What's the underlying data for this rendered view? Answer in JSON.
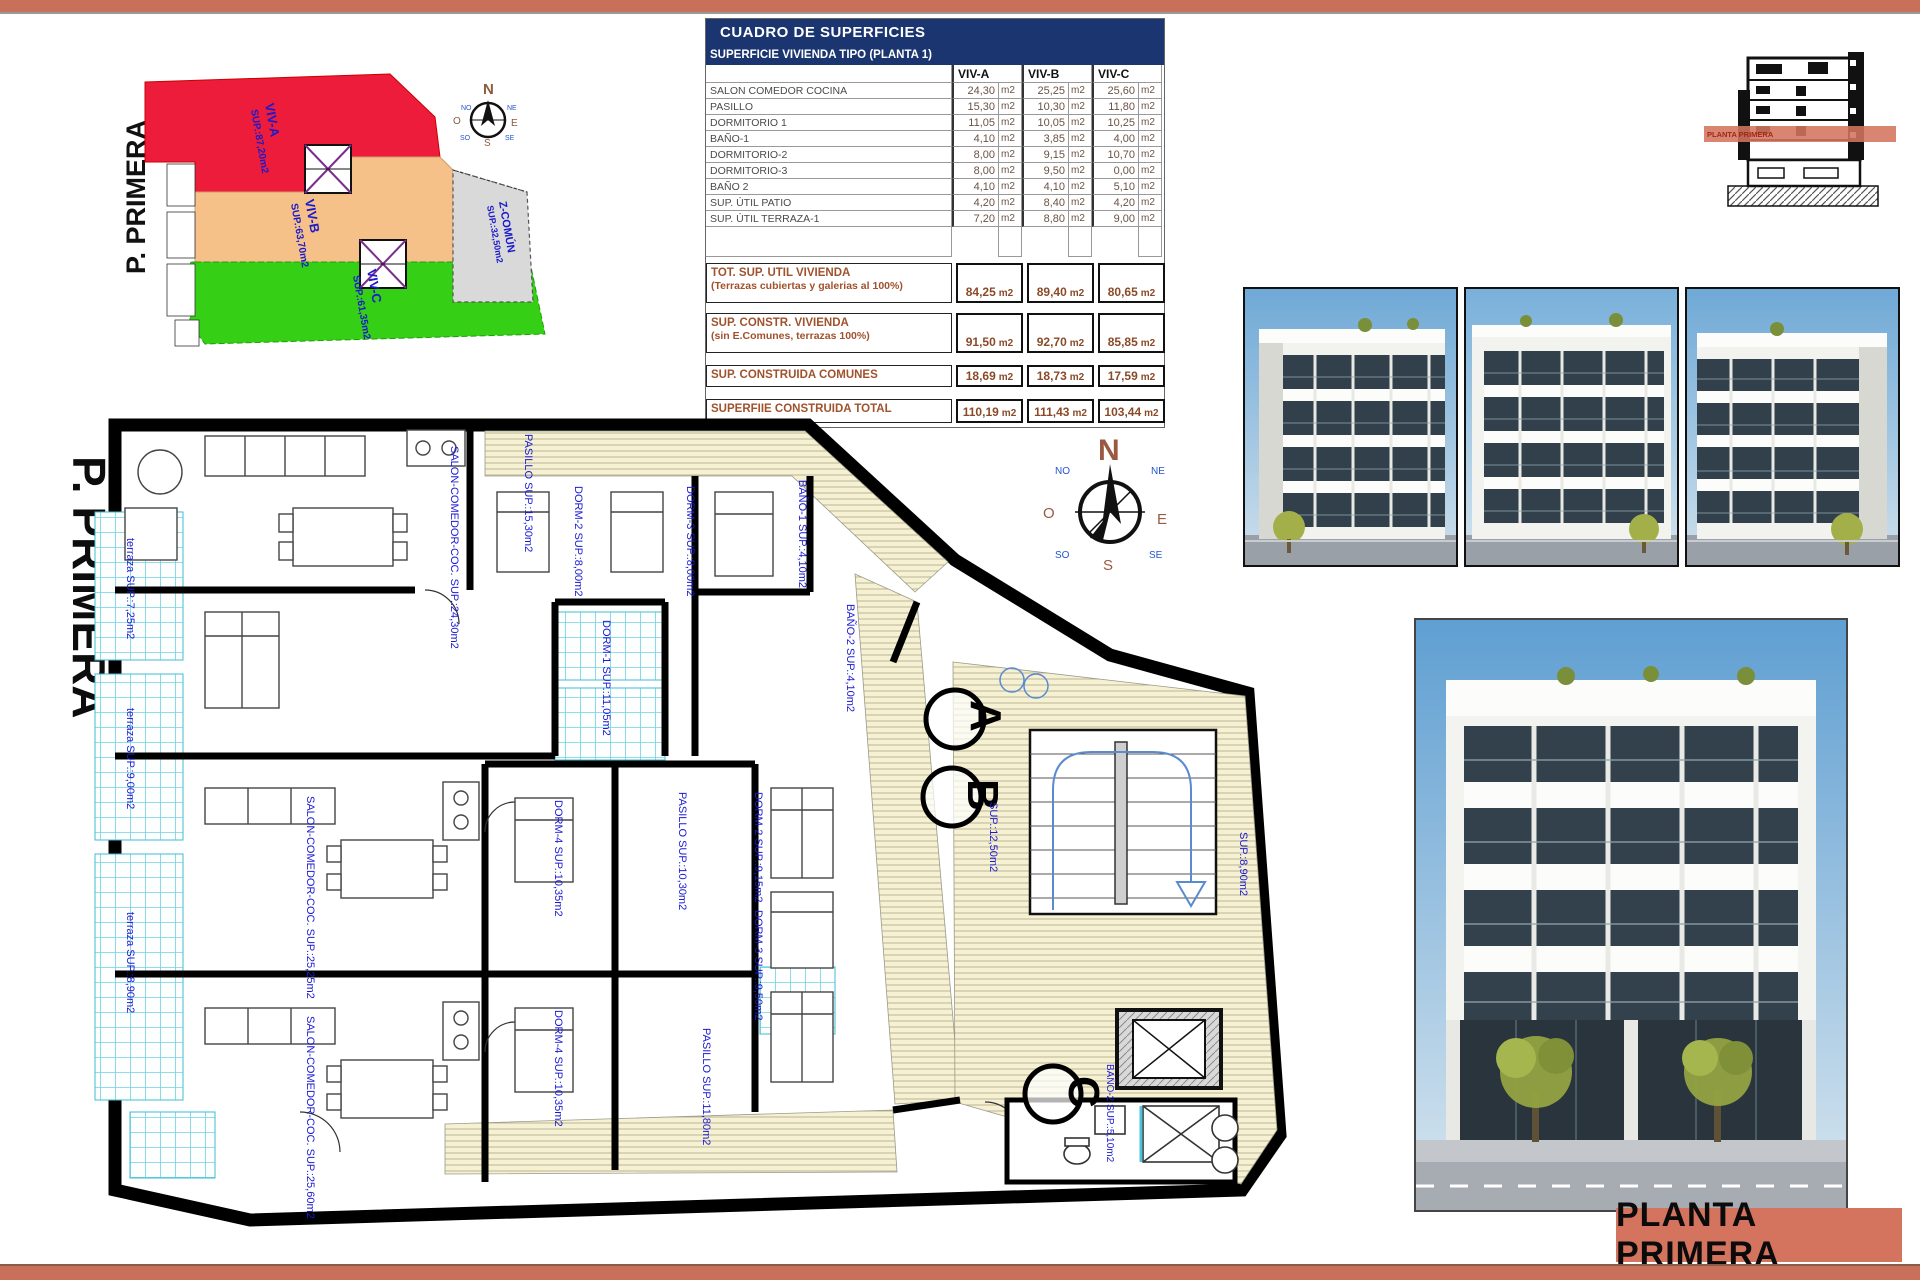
{
  "compass": {
    "n": "N",
    "ne": "NE",
    "e": "E",
    "se": "SE",
    "s": "S",
    "so": "SO",
    "o": "O",
    "no": "NO"
  },
  "title_block": {
    "label": "PLANTA PRIMERA"
  },
  "section_drawing": {
    "band_label": "PLANTA PRIMERA"
  },
  "key_plan": {
    "floor_label": "P. PRIMERA",
    "units": [
      {
        "name": "VIV-A",
        "sup": "SUP.:87,20m2",
        "color": "#ed1c3a"
      },
      {
        "name": "VIV-B",
        "sup": "SUP.:63,70m2",
        "color": "#f5c189"
      },
      {
        "name": "VIV-C",
        "sup": "SUP.:61,35m2",
        "color": "#35d015"
      },
      {
        "name": "Z-COMÚN",
        "sup": "SUP.:32,50m2",
        "color": "#d9d9d9"
      }
    ]
  },
  "table": {
    "title": "CUADRO DE SUPERFICIES",
    "subtitle": "SUPERFICIE VIVIENDA TIPO  (PLANTA 1)",
    "columns": [
      "VIV-A",
      "VIV-B",
      "VIV-C"
    ],
    "unit": "m2",
    "rows": [
      {
        "label": "SALON COMEDOR COCINA",
        "values": [
          "24,30",
          "25,25",
          "25,60"
        ]
      },
      {
        "label": "PASILLO",
        "values": [
          "15,30",
          "10,30",
          "11,80"
        ]
      },
      {
        "label": "DORMITORIO 1",
        "values": [
          "11,05",
          "10,05",
          "10,25"
        ]
      },
      {
        "label": "BAÑO-1",
        "values": [
          "4,10",
          "3,85",
          "4,00"
        ]
      },
      {
        "label": "DORMITORIO-2",
        "values": [
          "8,00",
          "9,15",
          "10,70"
        ]
      },
      {
        "label": "DORMITORIO-3",
        "values": [
          "8,00",
          "9,50",
          "0,00"
        ]
      },
      {
        "label": "BAÑO 2",
        "values": [
          "4,10",
          "4,10",
          "5,10"
        ]
      },
      {
        "label": "SUP. ÚTIL PATIO",
        "values": [
          "4,20",
          "8,40",
          "4,20"
        ]
      },
      {
        "label": "SUP. ÚTIL TERRAZA-1",
        "values": [
          "7,20",
          "8,80",
          "9,00"
        ]
      }
    ],
    "summary": [
      {
        "label": "TOT. SUP. UTIL VIVIENDA",
        "sublabel": "(Terrazas cubiertas y galerias al 100%)",
        "values": [
          "84,25",
          "89,40",
          "80,65"
        ]
      },
      {
        "label": "SUP. CONSTR. VIVIENDA",
        "sublabel": "(sin E.Comunes, terrazas 100%)",
        "values": [
          "91,50",
          "92,70",
          "85,85"
        ]
      },
      {
        "label": "SUP. CONSTRUIDA COMUNES",
        "sublabel": "",
        "values": [
          "18,69",
          "18,73",
          "17,59"
        ]
      },
      {
        "label": "SUPERFIIE CONSTRUIDA TOTAL",
        "sublabel": "",
        "values": [
          "110,19",
          "111,43",
          "103,44"
        ]
      }
    ]
  },
  "floor_plan": {
    "floor_label": "P. PRIMERA",
    "markers": [
      "A",
      "B",
      "C"
    ],
    "labels": [
      "SALON-COMEDOR-COC. SUP.:24,30m2",
      "PASILLO SUP.:15,30m2",
      "DORM-2 SUP.:8,00m2",
      "DORM-3 SUP.:8,00m2",
      "BAÑO-1 SUP.:4,10m2",
      "DORM-1 SUP.:11,05m2",
      "BAÑO-2 SUP.:4,10m2",
      "terraza SUP.:7,25m2",
      "terraza SUP.:9,00m2",
      "terraza SUP.:8,90m2",
      "SALON-COMEDOR-COC. SUP.:25,25m2",
      "SALON-COMEDOR-COC. SUP.:25,60m2",
      "DORM-4 SUP.:10,35m2",
      "DORM-4 SUP.:10,35m2",
      "DORM-2 SUP.:9,15m2",
      "DORM-3 SUP.:9,50m2",
      "PASILLO SUP.:10,30m2",
      "PASILLO SUP.:11,80m2",
      "SUP.:12,50m2",
      "SUP.:8,90m2",
      "BAÑO-2 SUP.:5,10m2"
    ]
  }
}
